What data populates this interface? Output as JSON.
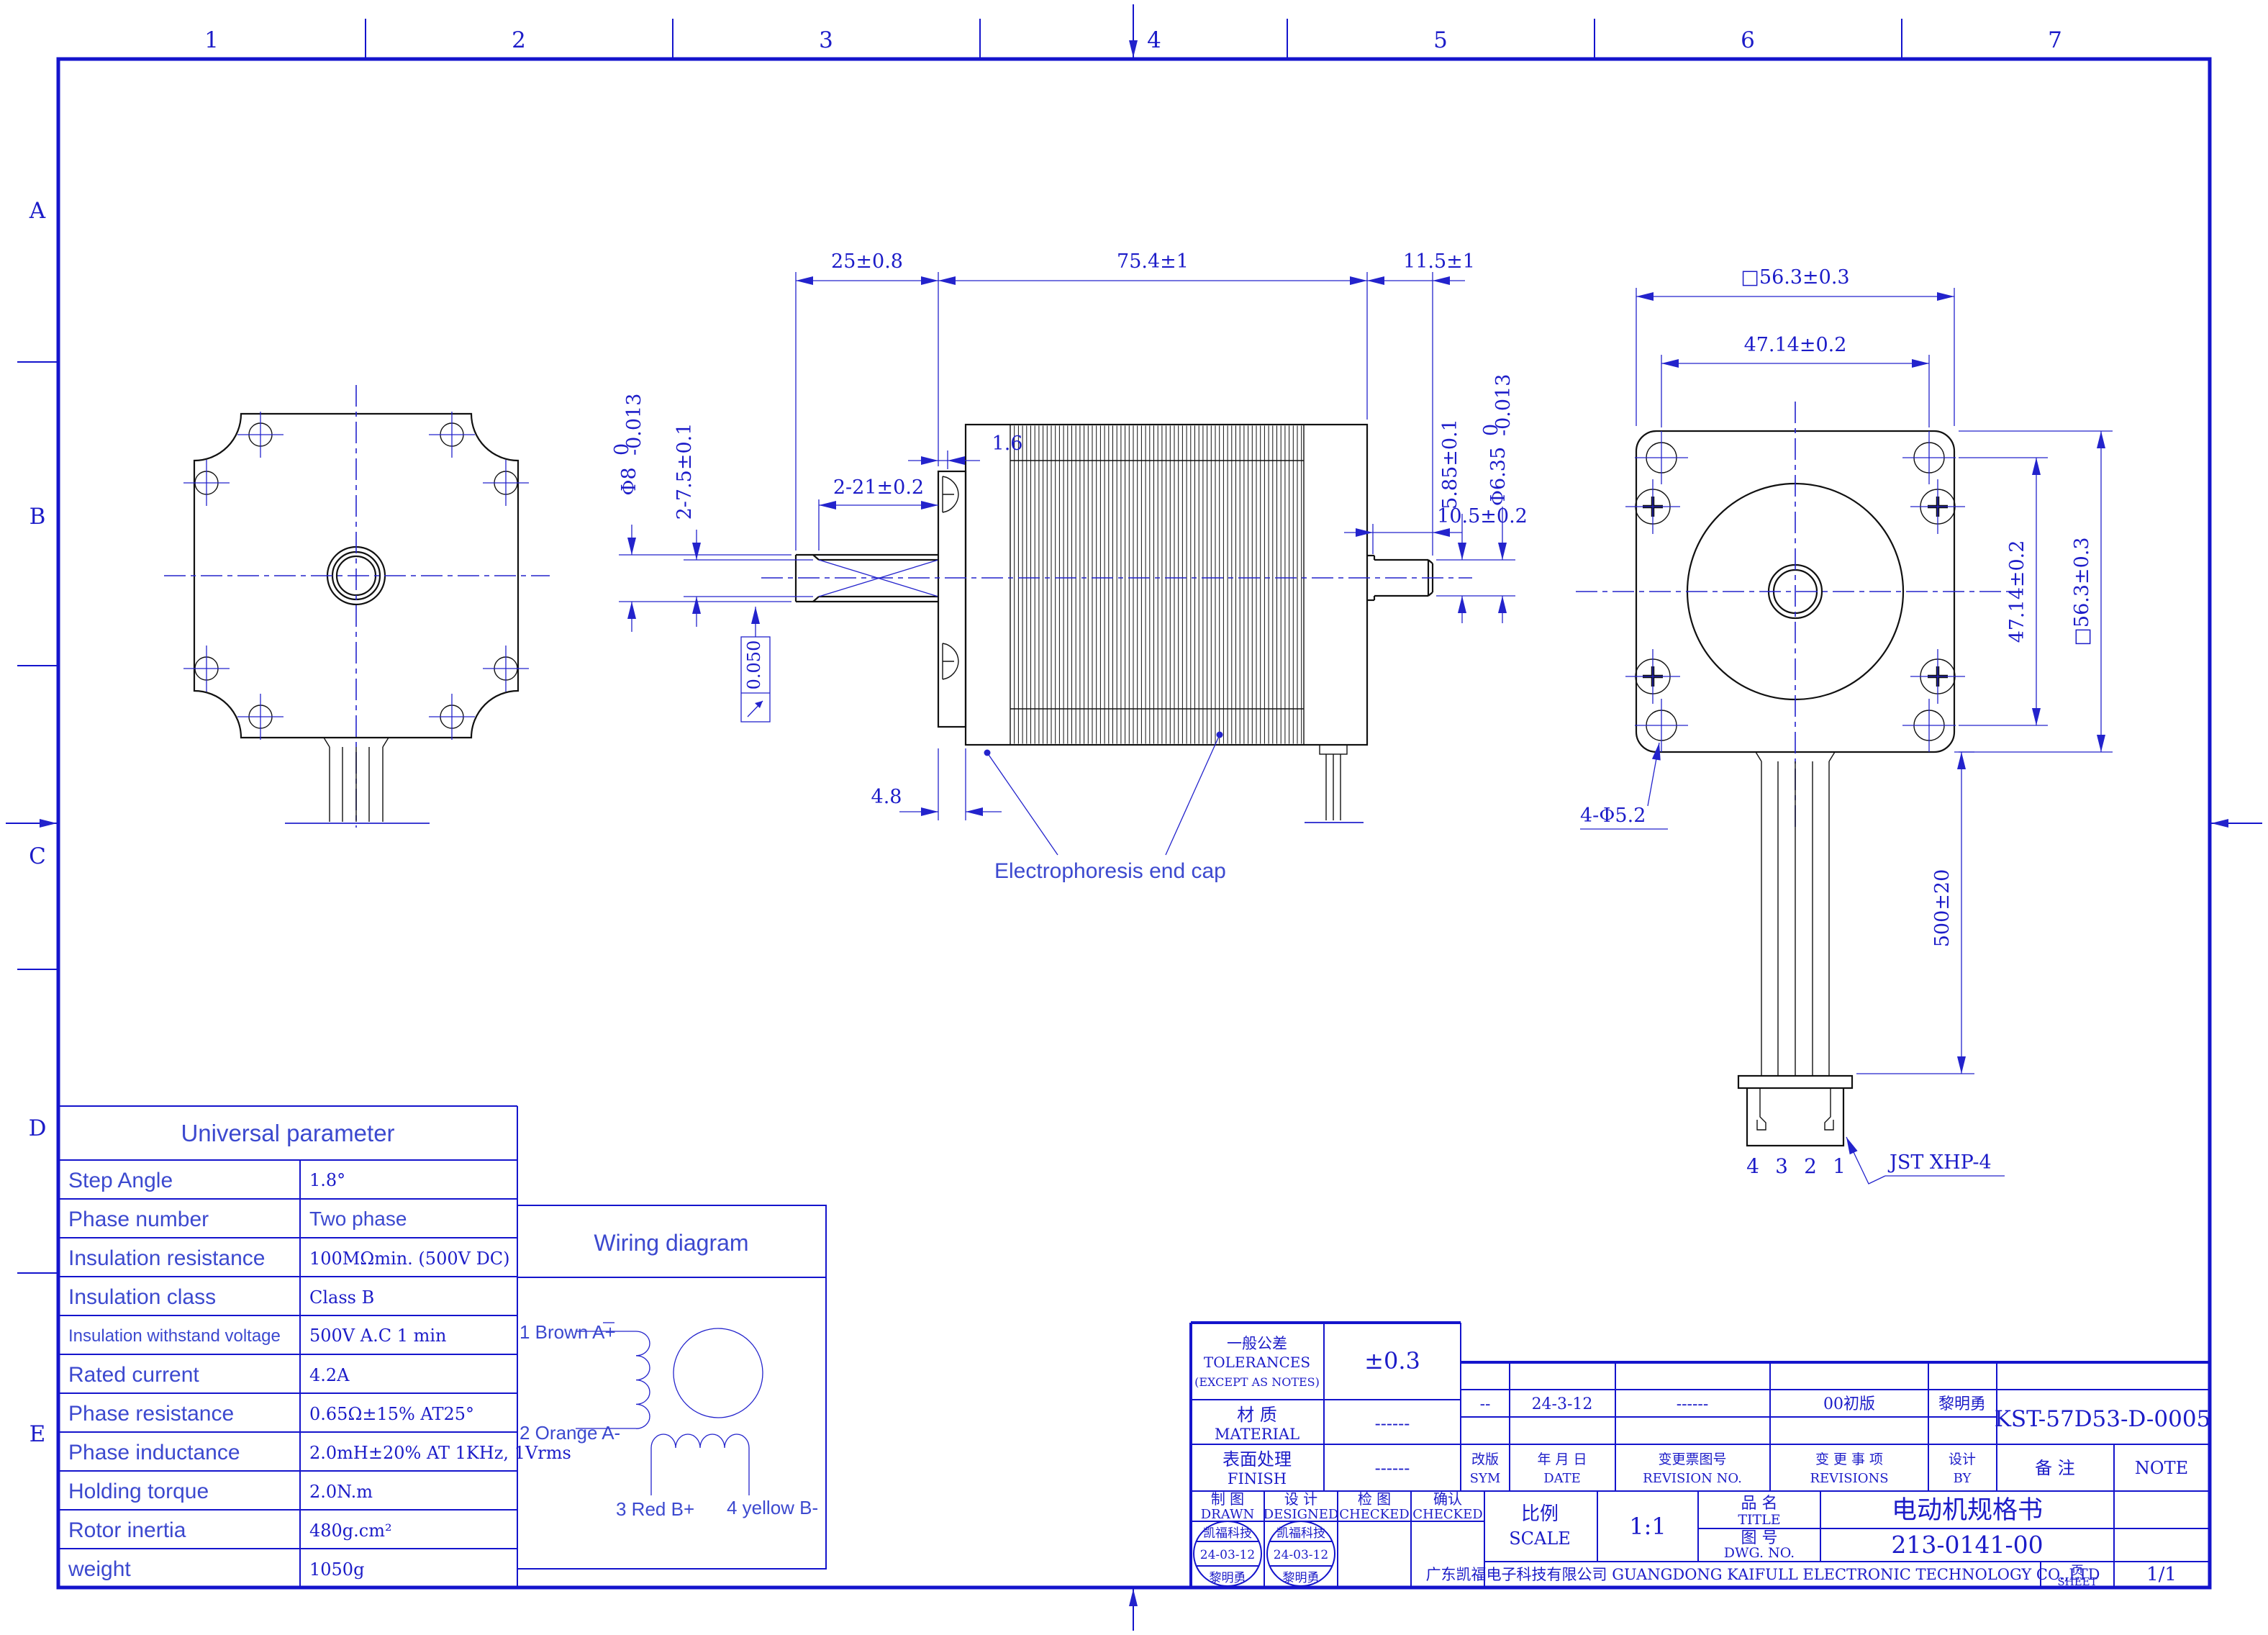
{
  "sheet": {
    "zone_columns": [
      "1",
      "2",
      "3",
      "4",
      "5",
      "6",
      "7"
    ],
    "zone_rows": [
      "A",
      "B",
      "C",
      "D",
      "E"
    ],
    "colors": {
      "line_blue": "#2323cc",
      "geometry_black": "#111111"
    }
  },
  "side_view": {
    "dim_front_shaft": "25±0.8",
    "dim_body_length": "75.4±1",
    "dim_rear_shaft": "11.5±1",
    "dim_boss": "1.6",
    "dim_rear_usable": "10.5±0.2",
    "dim_flat_length": "2-21±0.2",
    "dim_flat_width": "2-7.5±0.1",
    "dim_front_dia_main": "Φ8",
    "dim_front_dia_upper": "0",
    "dim_front_dia_lower": "-0.013",
    "dim_rear_flat": "5.85±0.1",
    "dim_rear_dia_main": "Φ6.35",
    "dim_rear_dia_upper": "0",
    "dim_rear_dia_lower": "-0.013",
    "runout_value": "0.050",
    "dim_plate_thickness": "4.8",
    "endcap_label": "Electrophoresis end cap"
  },
  "rear_view": {
    "dim_square_top": "□56.3±0.3",
    "dim_holes_top": "47.14±0.2",
    "dim_holes_right": "47.14±0.2",
    "dim_square_right": "□56.3±0.3",
    "dim_mount_holes": "4-Φ5.2",
    "dim_cable_length": "500±20",
    "pin_labels": [
      "4",
      "3",
      "2",
      "1"
    ],
    "connector_label": "JST XHP-4"
  },
  "param_table": {
    "title": "Universal parameter",
    "rows": [
      {
        "label": "Step Angle",
        "value": "1.8°"
      },
      {
        "label": "Phase number",
        "value": "Two phase"
      },
      {
        "label": "Insulation resistance",
        "value": "100MΩmin. (500V DC)"
      },
      {
        "label": "Insulation class",
        "value": "Class B"
      },
      {
        "label": "Insulation withstand voltage",
        "value": "500V A.C 1 min"
      },
      {
        "label": "Rated current",
        "value": "4.2A"
      },
      {
        "label": "Phase resistance",
        "value": "0.65Ω±15%  AT25°"
      },
      {
        "label": "Phase inductance",
        "value": "2.0mH±20%  AT 1KHz, 1Vrms"
      },
      {
        "label": "Holding torque",
        "value": "2.0N.m"
      },
      {
        "label": "Rotor inertia",
        "value": "480g.cm²"
      },
      {
        "label": "weight",
        "value": "1050g"
      }
    ]
  },
  "wiring": {
    "title": "Wiring diagram",
    "lead1": "1 Brown A+",
    "lead2": "2 Orange A-",
    "lead3": "3 Red B+",
    "lead4": "4 yellow B-"
  },
  "title_block": {
    "tolerances_cn": "一般公差",
    "tolerances_en": "TOLERANCES",
    "tolerances_note": "(EXCEPT AS NOTES)",
    "tolerances_value": "±0.3",
    "material_cn": "材  质",
    "material_en": "MATERIAL",
    "material_value": "------",
    "finish_cn": "表面处理",
    "finish_en": "FINISH",
    "finish_value": "------",
    "rev_sym_cn": "改版",
    "rev_sym_en": "SYM",
    "rev_date_cn": "年 月 日",
    "rev_date_en": "DATE",
    "rev_no_cn": "变更票图号",
    "rev_no_en": "REVISION NO.",
    "rev_items_cn": "变 更 事 项",
    "rev_items_en": "REVISIONS",
    "rev_by_cn": "设计",
    "rev_by_en": "BY",
    "rev_row": {
      "sym": "--",
      "date": "24-3-12",
      "no": "------",
      "item": "00初版",
      "by": "黎明勇"
    },
    "part_no": "KST-57D53-D-0005",
    "note_cn": "备    注",
    "note_en": "NOTE",
    "drawn_cn": "制  图",
    "drawn_en": "DRAWN",
    "designed_cn": "设  计",
    "designed_en": "DESIGNED",
    "checked_cn": "检  图",
    "checked_en": "CHECKED",
    "confirmed_cn": "确认",
    "confirmed_en": "CHECKED",
    "scale_cn": "比例",
    "scale_en": "SCALE",
    "scale_value": "1:1",
    "title_cn": "品  名",
    "title_en": "TITLE",
    "title_value": "电动机规格书",
    "dwg_cn": "图  号",
    "dwg_en": "DWG. NO.",
    "dwg_value": "213-0141-00",
    "company": "广东凯福电子科技有限公司 GUANGDONG KAIFULL ELECTRONIC TECHNOLOGY CO.,LTD",
    "sheet_cn": "页",
    "sheet_en": "SHEET",
    "sheet_value": "1/1",
    "stamp": {
      "line1": "凯福科技",
      "line2": "24-03-12",
      "line3": "黎明勇"
    }
  }
}
